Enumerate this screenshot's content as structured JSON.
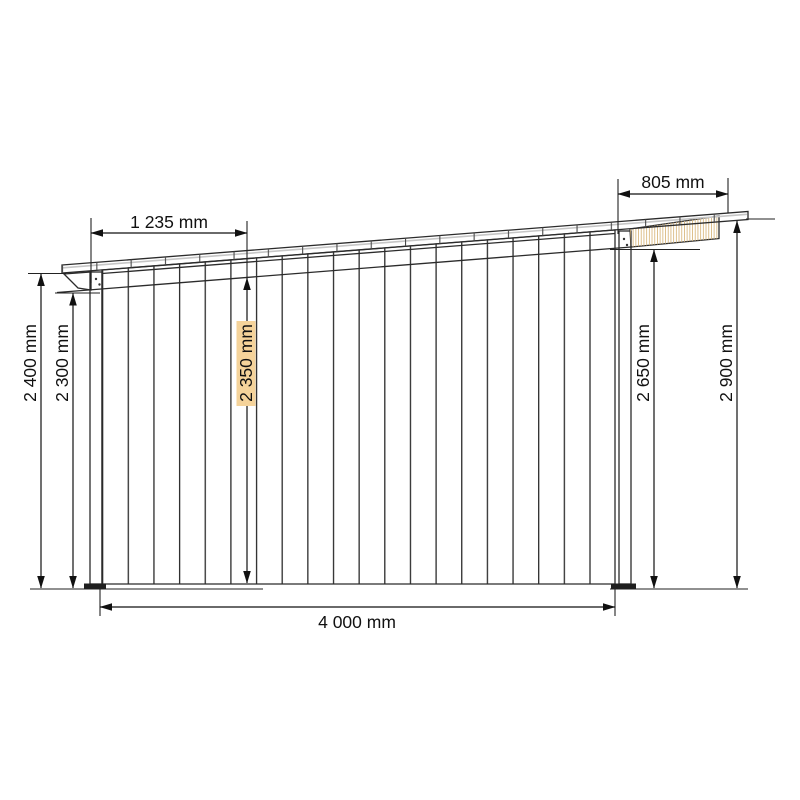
{
  "drawing": {
    "type": "technical-elevation",
    "subject": "Side elevation of a lean-to wooden shed with sloped mono-pitch roof and vertical plank cladding",
    "units": "mm"
  },
  "dimensions": {
    "roof_left_offset": "1 235 mm",
    "roof_right_overhang": "805 mm",
    "wall_left_outer_height": "2 400 mm",
    "wall_left_inner_height": "2 300 mm",
    "wall_mid_height": "2 350 mm",
    "wall_right_inner_height": "2 650 mm",
    "roof_right_height": "2 900 mm",
    "wall_width": "4 000 mm"
  },
  "colors": {
    "plank": "#F5D39A",
    "fascia": "#EDCE96",
    "roof_band": "#8A8A8A",
    "roof_band_highlight": "#C6C6C6",
    "outline": "#2B2B2B",
    "dimension": "#111111",
    "post_fill": "#FFFFFF",
    "foot": "#1F1F1F",
    "background": "#FFFFFF"
  }
}
